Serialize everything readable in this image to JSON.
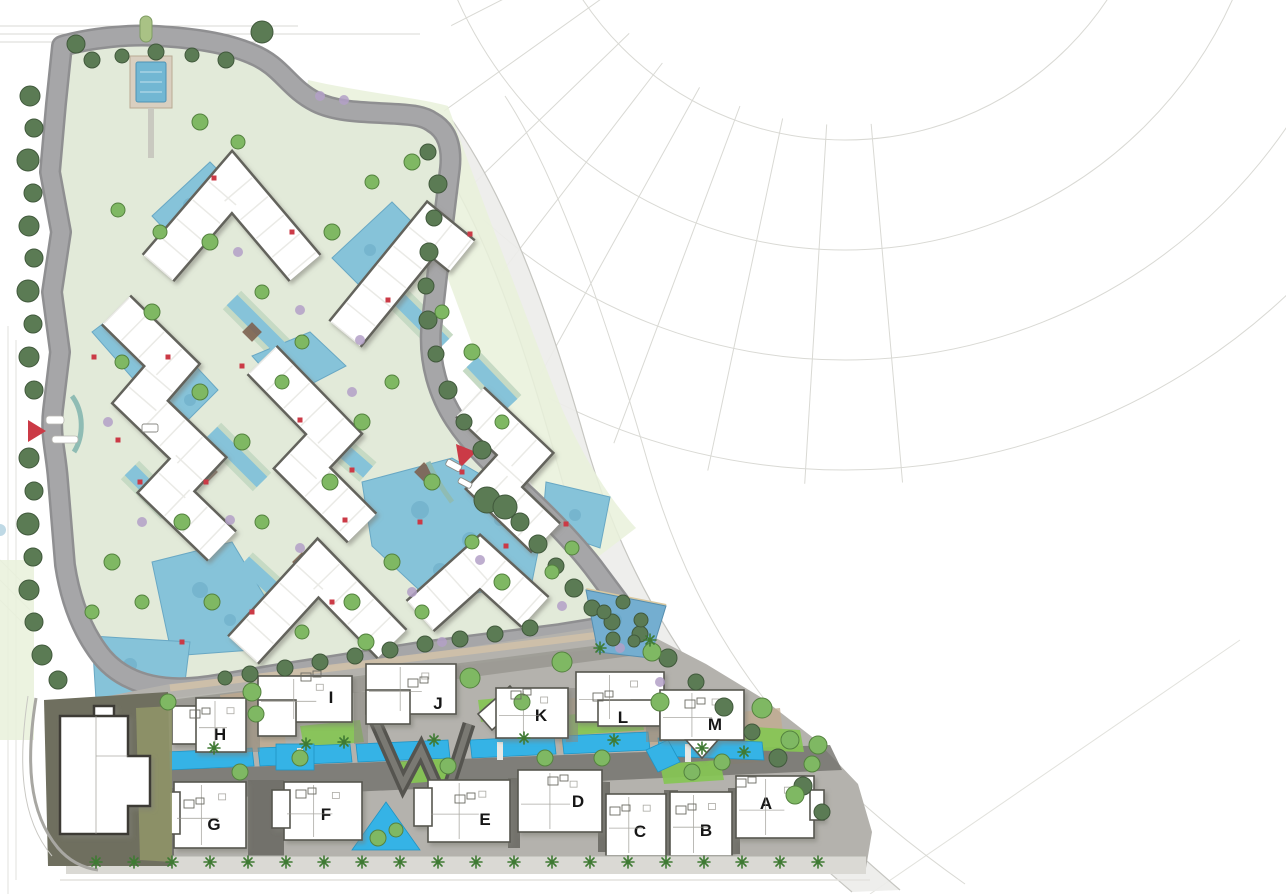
{
  "map_title": "residential-community-masterplan",
  "building_labels": {
    "h": "H",
    "i": "I",
    "j": "J",
    "k": "K",
    "l": "L",
    "m": "M",
    "g": "G",
    "f": "F",
    "e": "E",
    "d": "D",
    "c": "C",
    "b": "B",
    "a": "A"
  },
  "colors": {
    "paper": "#ffffff",
    "cad_line": "#d9d9d4",
    "corridor": "#ececea",
    "road": "#a6a6a8",
    "road_edge": "#8f8f91",
    "sage_plate": "#e2ead9",
    "pool_blue": "#86c3d9",
    "pool_speckle": "#5e9fbd",
    "canal_cyan": "#35b3e6",
    "lawn_wash": "#e9f1da",
    "grass_bright": "#86c554",
    "tree_dark": "#5b7b54",
    "tree_light": "#7fb863",
    "palm_green": "#3f7a33",
    "shrub_purple": "#b3a0c7",
    "accent_red": "#cb3a46",
    "deck_dark": "#55544f",
    "tan_paving": "#c3ab8f",
    "strip_base": "#b4b2ad",
    "plot_olive": "#6f6f5f",
    "outline_dark": "#57564f"
  }
}
